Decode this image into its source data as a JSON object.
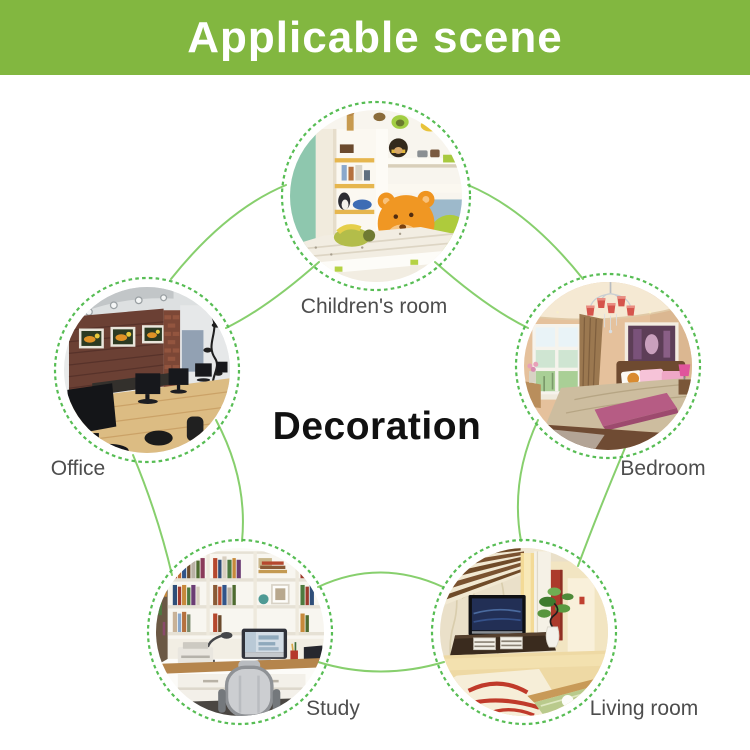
{
  "banner": {
    "title": "Applicable scene"
  },
  "center_label": "Decoration",
  "scenes": [
    {
      "id": "children-room",
      "label": "Children's room"
    },
    {
      "id": "office",
      "label": "Office"
    },
    {
      "id": "bedroom",
      "label": "Bedroom"
    },
    {
      "id": "study",
      "label": "Study"
    },
    {
      "id": "living-room",
      "label": "Living room"
    }
  ],
  "colors": {
    "banner_green": "#82b740",
    "banner_text": "#ffffff",
    "line_green": "#87cf6d",
    "ring_green": "#57bd54",
    "label_gray": "#4d4d4d",
    "center_text": "#111111"
  }
}
